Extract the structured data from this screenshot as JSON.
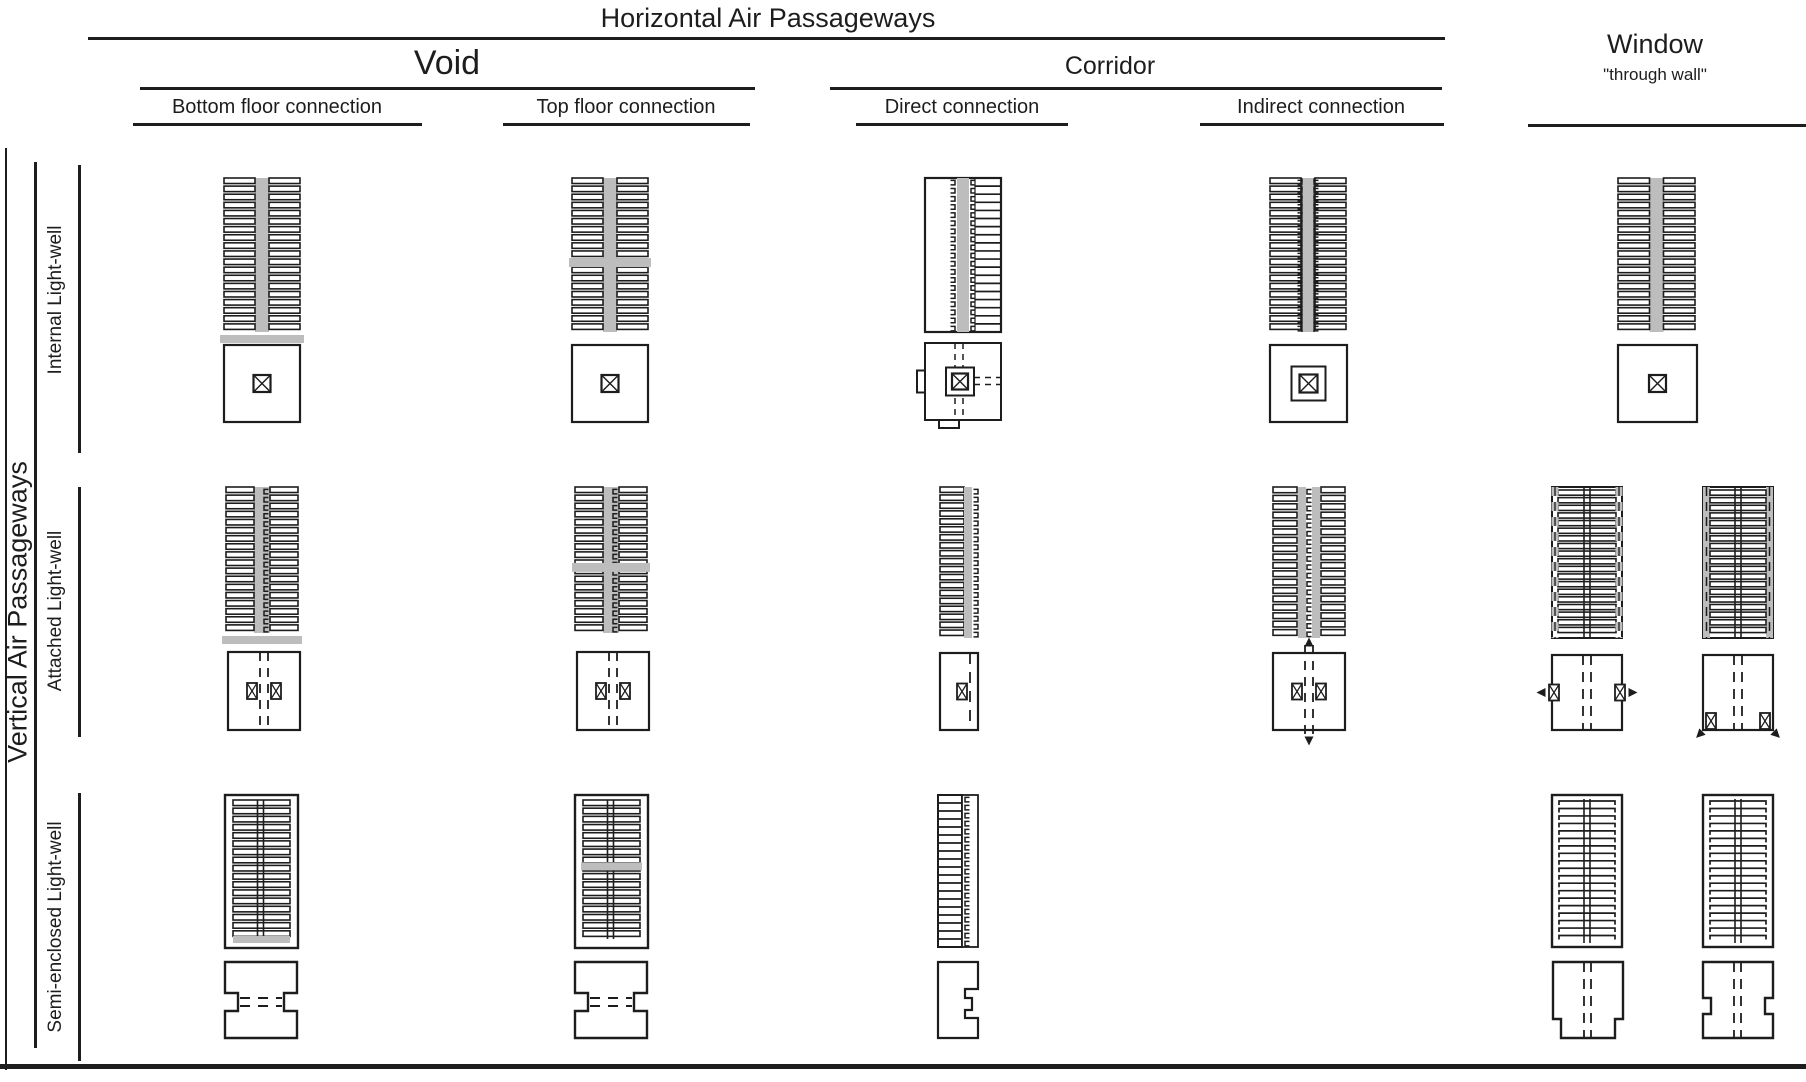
{
  "title": "Horizontal Air Passageways",
  "vertical_axis_label": "Vertical Air Passageways",
  "column_groups": [
    {
      "id": "void",
      "label": "Void",
      "columns": [
        {
          "id": "bottom",
          "label": "Bottom floor connection"
        },
        {
          "id": "top",
          "label": "Top floor connection"
        }
      ]
    },
    {
      "id": "corridor",
      "label": "Corridor",
      "columns": [
        {
          "id": "direct",
          "label": "Direct connection"
        },
        {
          "id": "indirect",
          "label": "Indirect connection"
        }
      ]
    },
    {
      "id": "window",
      "label": "Window",
      "sublabel": "\"through wall\"",
      "columns": []
    }
  ],
  "rows": [
    {
      "id": "internal",
      "label": "Internal Light-well"
    },
    {
      "id": "attached",
      "label": "Attached Light-well"
    },
    {
      "id": "semi",
      "label": "Semi-enclosed Light-well"
    }
  ],
  "cells": [
    {
      "row": "internal",
      "column": "bottom",
      "diagrams": [
        {
          "section": "sec-void-bottom",
          "plan": "plan-internal-xbox"
        }
      ]
    },
    {
      "row": "internal",
      "column": "top",
      "diagrams": [
        {
          "section": "sec-void-top",
          "plan": "plan-internal-xbox"
        }
      ]
    },
    {
      "row": "internal",
      "column": "direct",
      "diagrams": [
        {
          "section": "sec-corridor-direct-internal",
          "plan": "plan-internal-direct"
        }
      ]
    },
    {
      "row": "internal",
      "column": "indirect",
      "diagrams": [
        {
          "section": "sec-corridor-indirect-internal",
          "plan": "plan-internal-ring-xbox"
        }
      ]
    },
    {
      "row": "internal",
      "column": "window",
      "diagrams": [
        {
          "section": "sec-void-plain",
          "plan": "plan-internal-xbox"
        }
      ]
    },
    {
      "row": "attached",
      "column": "bottom",
      "diagrams": [
        {
          "section": "sec-attached-bottom",
          "plan": "plan-attached-twin-windows"
        }
      ]
    },
    {
      "row": "attached",
      "column": "top",
      "diagrams": [
        {
          "section": "sec-attached-top",
          "plan": "plan-attached-twin-windows"
        }
      ]
    },
    {
      "row": "attached",
      "column": "direct",
      "diagrams": [
        {
          "section": "sec-attached-direct",
          "plan": "plan-attached-direct"
        }
      ]
    },
    {
      "row": "attached",
      "column": "indirect",
      "diagrams": [
        {
          "section": "sec-attached-indirect",
          "plan": "plan-attached-indirect-arrows"
        }
      ]
    },
    {
      "row": "attached",
      "column": "window",
      "diagrams": [
        {
          "section": "sec-window-attached-dashed",
          "plan": "plan-window-side-arrows"
        },
        {
          "section": "sec-window-attached-solid",
          "plan": "plan-window-corner-arrows"
        }
      ]
    },
    {
      "row": "semi",
      "column": "bottom",
      "diagrams": [
        {
          "section": "sec-semi-bottom",
          "plan": "plan-semi-waist"
        }
      ]
    },
    {
      "row": "semi",
      "column": "top",
      "diagrams": [
        {
          "section": "sec-semi-top",
          "plan": "plan-semi-waist"
        }
      ]
    },
    {
      "row": "semi",
      "column": "direct",
      "diagrams": [
        {
          "section": "sec-semi-direct",
          "plan": "plan-semi-direct-notch"
        }
      ]
    },
    {
      "row": "semi",
      "column": "window",
      "diagrams": [
        {
          "section": "sec-semi-window",
          "plan": "plan-semi-window-step"
        },
        {
          "section": "sec-semi-window",
          "plan": "plan-semi-window-notch"
        }
      ]
    }
  ],
  "colors": {
    "line": "#1d1d1d",
    "gray": "#bdbdbd"
  }
}
